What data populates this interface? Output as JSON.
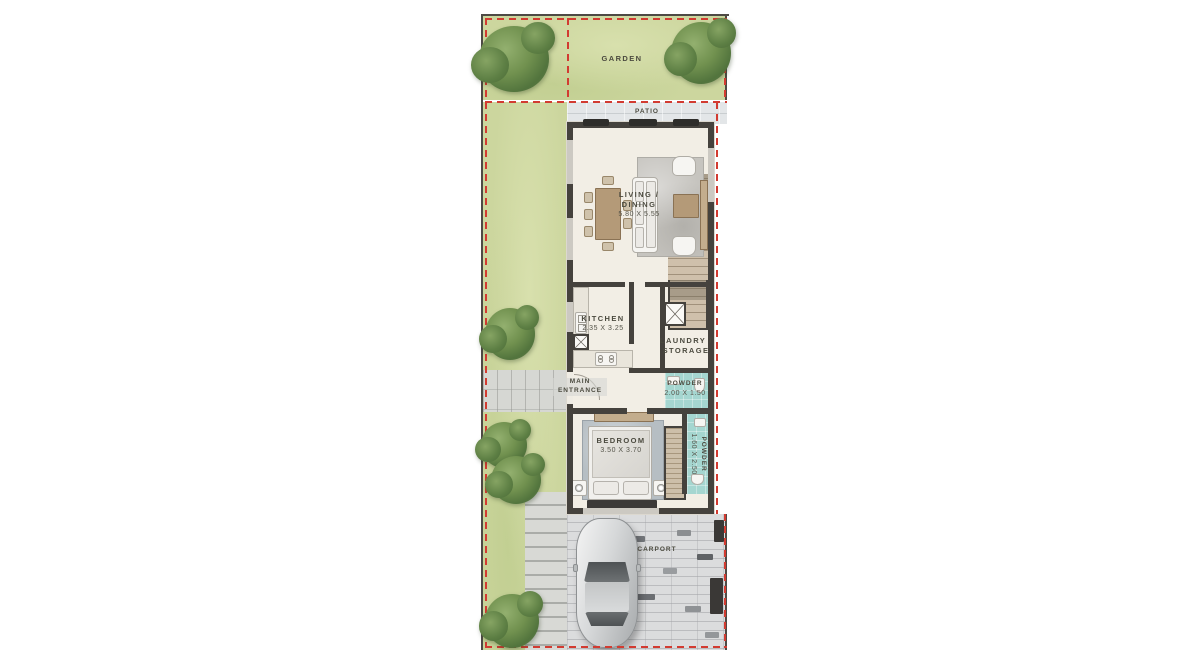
{
  "plan_title": "Townhouse ground floor plan",
  "areas": {
    "garden": "GARDEN",
    "patio": "PATIO",
    "carport": "CARPORT",
    "entrance_line1": "MAIN",
    "entrance_line2": "ENTRANCE"
  },
  "rooms": {
    "living": {
      "line1": "LIVING /",
      "line2": "DINING",
      "dims": "5.80 X 5.55"
    },
    "kitchen": {
      "name": "KITCHEN",
      "dims": "2.35 X 3.25"
    },
    "laundry": {
      "line1": "LAUNDRY /",
      "line2": "STORAGE"
    },
    "powder1": {
      "name": "POWDER",
      "dims": "2.00 X 1.50"
    },
    "bedroom": {
      "name": "BEDROOM",
      "dims": "3.50 X 3.70"
    },
    "powder2": {
      "name": "POWDER",
      "dims": "1.60 X 2.50"
    }
  },
  "colors": {
    "boundary_red": "#d23b31",
    "wall_dark": "#45423d",
    "garden_green": "#ccd69e",
    "tree_green": "#71914f",
    "floor_cream": "#f2eee5",
    "bath_teal": "#a5d6d0",
    "patio_gray": "#e3e6e8",
    "carport_gray": "#dbdcdd",
    "wood_tan": "#b49a78"
  }
}
